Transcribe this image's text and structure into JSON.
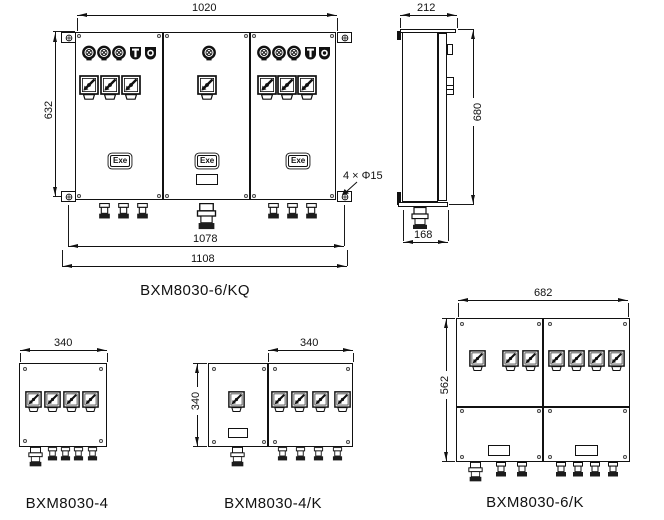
{
  "page": {
    "background": "#ffffff",
    "line_color": "#111111"
  },
  "views": {
    "main": {
      "label": "BXM8030-6/KQ",
      "dims": {
        "top": "1020",
        "left": "632",
        "bottom_inner": "1078",
        "bottom_outer": "1108"
      },
      "holes_note": "4 × Φ15",
      "exe_marking": "Exe"
    },
    "side": {
      "dims": {
        "top": "212",
        "right": "680",
        "bottom": "168"
      }
    },
    "box4": {
      "label": "BXM8030-4",
      "dims": {
        "top": "340"
      }
    },
    "box4k": {
      "label": "BXM8030-4/K",
      "dims": {
        "top": "340",
        "left": "340"
      }
    },
    "box6k": {
      "label": "BXM8030-6/K",
      "dims": {
        "top": "682",
        "left": "562"
      }
    }
  }
}
